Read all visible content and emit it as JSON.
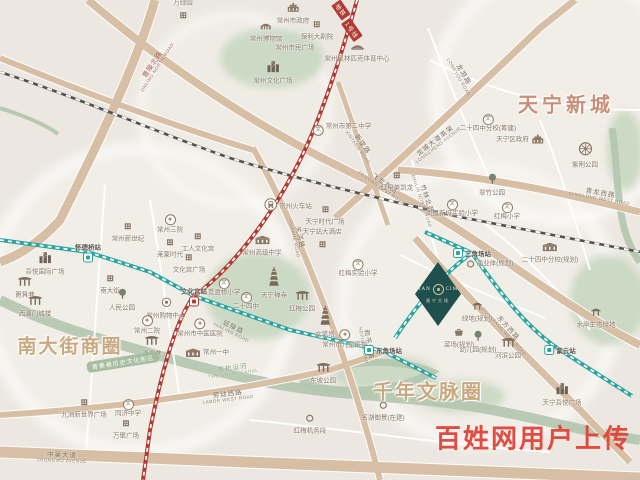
{
  "colors": {
    "bg": "#ece8e1",
    "road": "#d7bfa5",
    "water": "#b3c5ae",
    "park": "#ccd9c5",
    "metro_teal": "#2aa49e",
    "metro_red": "#b13a32",
    "poi_text": "#8a7868",
    "area_text": "#c8a87e",
    "tianning_text": "#c78e78",
    "project_bg": "#20504e",
    "watermark": "#e2433a",
    "band_green": "#a3bb9e"
  },
  "project": {
    "t1": "TAN",
    "t2": "CIM",
    "sub": "唐宁大境"
  },
  "watermark": {
    "text": "百姓网用户上传"
  },
  "band_label": {
    "text": "青果巷历史文化街区"
  },
  "metro_banner": {
    "parts": [
      {
        "text": "地铁",
        "x": 341,
        "y": 10
      },
      {
        "text": "1号线",
        "x": 352,
        "y": 30
      }
    ]
  },
  "map": {
    "big_labels": [
      {
        "text": "天宁新城",
        "x": 566,
        "y": 103,
        "size": 20,
        "ls": 4,
        "cls": "tianning"
      },
      {
        "text": "南大街商圈",
        "x": 70,
        "y": 345,
        "size": 19,
        "ls": 2,
        "cls": "area"
      },
      {
        "text": "千年文脉圈",
        "x": 428,
        "y": 390,
        "size": 20,
        "ls": 2,
        "cls": "area"
      }
    ],
    "stations": [
      {
        "label": "怀德桥站",
        "x": 88,
        "y": 252,
        "line": "teal",
        "pos": "above"
      },
      {
        "label": "文化宫站",
        "x": 194,
        "y": 296,
        "line": "red",
        "pos": "above"
      },
      {
        "label": "东角场站",
        "x": 383,
        "y": 350,
        "line": "teal",
        "pos": "right"
      },
      {
        "label": "三角场站",
        "x": 472,
        "y": 253,
        "line": "teal",
        "pos": "right"
      },
      {
        "label": "紫云站",
        "x": 560,
        "y": 350,
        "line": "teal",
        "pos": "right"
      }
    ],
    "road_labels": [
      {
        "m": "晋陵北路",
        "s": "JINLING NORTH ROAD",
        "x": 155,
        "y": 66,
        "rot": -57,
        "color": "#a0524a"
      },
      {
        "m": "关河路",
        "s": "GUANHE ROAD",
        "x": 297,
        "y": 238,
        "rot": 78
      },
      {
        "m": "飞龙东路",
        "s": "FEILONG EAST ROAD",
        "x": 383,
        "y": 186,
        "rot": 35
      },
      {
        "m": "竹林北路",
        "s": "ZHULIN NORTH ROAD",
        "x": 424,
        "y": 200,
        "rot": 72
      },
      {
        "m": "新堂路",
        "s": "XINTANG ROAD",
        "x": 360,
        "y": 146,
        "rot": 55
      },
      {
        "m": "龙游路",
        "s": "LONGYOU ROAD",
        "x": 461,
        "y": 76,
        "rot": 60
      },
      {
        "m": "龙城大道高架",
        "s": "LONGCHENG AVENUE",
        "x": 437,
        "y": 143,
        "rot": -38
      },
      {
        "m": "青龙西路",
        "s": "QINGLONG WEST ROAD",
        "x": 600,
        "y": 196,
        "rot": 10
      },
      {
        "m": "东方西路",
        "s": "DONGFANG WEST ROAD",
        "x": 506,
        "y": 330,
        "rot": 48
      },
      {
        "m": "劳动西路",
        "s": "LABOR WEST ROAD",
        "x": 228,
        "y": 397,
        "rot": -7
      },
      {
        "m": "中吴大道",
        "s": "ZHONGWU AVENUE",
        "x": 62,
        "y": 458,
        "rot": 2
      },
      {
        "m": "延陵路",
        "s": "YANLING ROAD",
        "x": 232,
        "y": 330,
        "rot": 26
      },
      {
        "m": "和平中路",
        "s": "HEPING ROAD",
        "x": 366,
        "y": 345,
        "rot": 80
      },
      {
        "m": "京杭运河",
        "s": "THE GRAND CANAL",
        "x": 233,
        "y": 371,
        "rot": -8,
        "cls": "river"
      }
    ],
    "pois": [
      {
        "label": "万绿园",
        "x": 183,
        "y": 12,
        "icon": "building",
        "pos": "above"
      },
      {
        "label": "常州市政府",
        "x": 293,
        "y": 12,
        "icon": "gov"
      },
      {
        "label": "常州博物馆",
        "x": 266,
        "y": 30,
        "icon": "museum"
      },
      {
        "label": "保利大剧院",
        "x": 317,
        "y": 28,
        "icon": "building"
      },
      {
        "label": "常州市民广场",
        "x": 295,
        "y": 48,
        "icon": "none"
      },
      {
        "label": "常州文化广场",
        "x": 273,
        "y": 72,
        "icon": "skyline"
      },
      {
        "label": "常州奥林匹克体育中心",
        "x": 357,
        "y": 50,
        "icon": "stadium"
      },
      {
        "label": "红星美凯龙",
        "x": 397,
        "y": 179,
        "icon": "building"
      },
      {
        "label": "常州火车站",
        "x": 288,
        "y": 207,
        "icon": "train",
        "pos": "right"
      },
      {
        "label": "天宁时代广场",
        "x": 325,
        "y": 213,
        "icon": "building"
      },
      {
        "label": "天宁站大酒店",
        "x": 322,
        "y": 241,
        "icon": "building",
        "pos": "above"
      },
      {
        "label": "常州高级中学",
        "x": 262,
        "y": 244,
        "icon": "school2"
      },
      {
        "label": "常州市第二中学",
        "x": 342,
        "y": 127,
        "icon": "school",
        "pos": "right"
      },
      {
        "label": "天宁禅寺",
        "x": 274,
        "y": 283,
        "icon": "pagoda"
      },
      {
        "label": "红梅公园",
        "x": 302,
        "y": 300,
        "icon": "gate"
      },
      {
        "label": "文笔塔",
        "x": 325,
        "y": 322,
        "icon": "pagoda"
      },
      {
        "label": "红梅实验小学",
        "x": 358,
        "y": 265,
        "icon": "school"
      },
      {
        "label": "常州市儿童医院",
        "x": 345,
        "y": 336,
        "icon": "hospital"
      },
      {
        "label": "常州一中",
        "x": 207,
        "y": 353,
        "icon": "school2",
        "pos": "right"
      },
      {
        "label": "常州市中医医院",
        "x": 200,
        "y": 325,
        "icon": "hospital"
      },
      {
        "label": "觅渡桥小学",
        "x": 224,
        "y": 284,
        "icon": "school"
      },
      {
        "label": "二十四中",
        "x": 246,
        "y": 298,
        "icon": "school"
      },
      {
        "label": "工人文化宫",
        "x": 198,
        "y": 240,
        "icon": "building"
      },
      {
        "label": "莱蒙时代",
        "x": 170,
        "y": 246,
        "icon": "building"
      },
      {
        "label": "常州新世纪",
        "x": 128,
        "y": 230,
        "icon": "building"
      },
      {
        "label": "常州三院",
        "x": 170,
        "y": 221,
        "icon": "hospital"
      },
      {
        "label": "文化宫广场",
        "x": 189,
        "y": 261,
        "icon": "building"
      },
      {
        "label": "吾悦国际广场",
        "x": 45,
        "y": 263,
        "icon": "skyline"
      },
      {
        "label": "篦箕巷",
        "x": 25,
        "y": 286,
        "icon": "gate"
      },
      {
        "label": "西瀛门城楼",
        "x": 35,
        "y": 305,
        "icon": "gate"
      },
      {
        "label": "南大街",
        "x": 110,
        "y": 282,
        "icon": "building"
      },
      {
        "label": "人民公园",
        "x": 122,
        "y": 299,
        "icon": "tree"
      },
      {
        "label": "常州购物中心",
        "x": 166,
        "y": 307,
        "icon": "mall"
      },
      {
        "label": "常州二院",
        "x": 147,
        "y": 322,
        "icon": "hospital"
      },
      {
        "label": "青果巷",
        "x": 152,
        "y": 345,
        "icon": "gate"
      },
      {
        "label": "九洲新世界广场",
        "x": 84,
        "y": 406,
        "icon": "building"
      },
      {
        "label": "同济中学",
        "x": 128,
        "y": 405,
        "icon": "school"
      },
      {
        "label": "万聚广场",
        "x": 126,
        "y": 427,
        "icon": "building"
      },
      {
        "label": "东坡公园",
        "x": 323,
        "y": 372,
        "icon": "gate"
      },
      {
        "label": "红梅机务段",
        "x": 310,
        "y": 422,
        "icon": "dot"
      },
      {
        "label": "名湖御景(在建)",
        "x": 383,
        "y": 409,
        "icon": "dot"
      },
      {
        "label": "二十四中分校(筹建)",
        "x": 488,
        "y": 120,
        "icon": "school"
      },
      {
        "label": "天宁区政府",
        "x": 520,
        "y": 140,
        "icon": "gov",
        "pos": "left"
      },
      {
        "label": "紫荆公园",
        "x": 585,
        "y": 155,
        "icon": "ferris"
      },
      {
        "label": "翠竹公园",
        "x": 492,
        "y": 184,
        "icon": "tree"
      },
      {
        "label": "凤凰新城实验小学",
        "x": 452,
        "y": 205,
        "icon": "school"
      },
      {
        "label": "红梅小学",
        "x": 507,
        "y": 208,
        "icon": "school"
      },
      {
        "label": "二十四中分校(规划)",
        "x": 550,
        "y": 251,
        "icon": "school2"
      },
      {
        "label": "商业体(规划)",
        "x": 490,
        "y": 264,
        "icon": "dot",
        "pos": "right"
      },
      {
        "label": "绿地(规划)",
        "x": 477,
        "y": 310,
        "icon": "pavilion"
      },
      {
        "label": "菜场(规划)",
        "x": 459,
        "y": 336,
        "icon": "basket"
      },
      {
        "label": "幼儿园(规划)",
        "x": 478,
        "y": 341,
        "icon": "tree"
      },
      {
        "label": "河滨公园",
        "x": 508,
        "y": 347,
        "icon": "gate"
      },
      {
        "label": "天宁吾悦广场",
        "x": 562,
        "y": 394,
        "icon": "skyline"
      },
      {
        "label": "水岸生态绿地",
        "x": 596,
        "y": 316,
        "icon": "pavilion"
      }
    ]
  }
}
